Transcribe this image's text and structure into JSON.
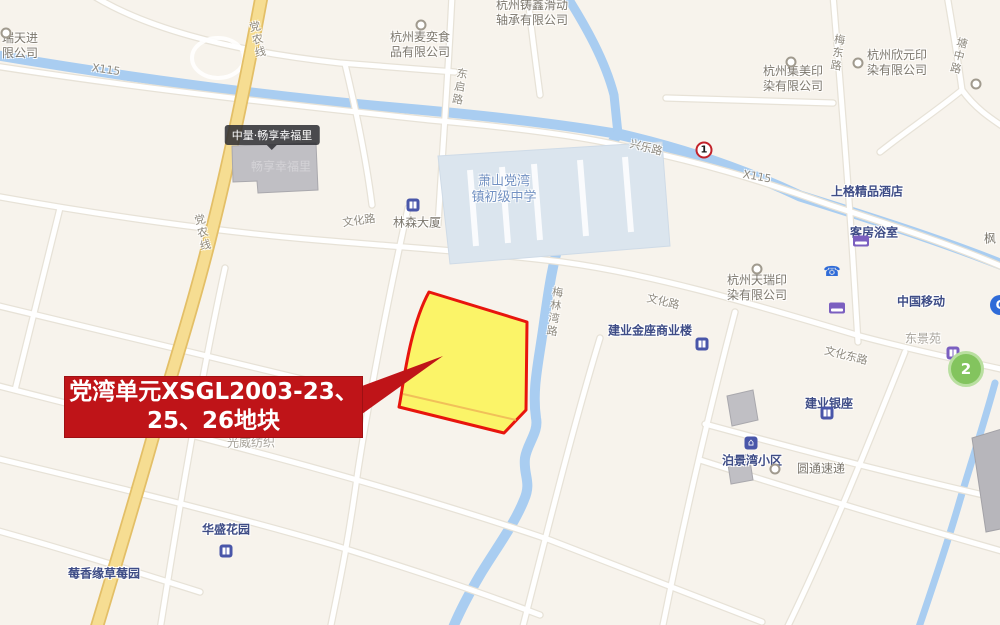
{
  "callout": {
    "line1": "党湾单元XSGL2003-23、",
    "line2": "25、26地块"
  },
  "roads": {
    "x115_nw": "X115",
    "x115_e": "X115",
    "dangnong_n": "党农线",
    "dangnong_s": "党农线",
    "dongqi": "东启路",
    "xingle": "兴乐路",
    "meidong": "梅东路",
    "tangzhong": "塘中路",
    "wenhua_w": "文化路",
    "wenhua_e": "文化路",
    "wenhuadong": "文化东路",
    "meilinwan": "梅林湾路"
  },
  "places": {
    "ruitianjin": "瑞天进\n限公司",
    "zhuxin": "杭州铸鑫滑动\n轴承有限公司",
    "maiyi": "杭州麦奕食\n品有限公司",
    "jimei": "杭州集美印\n染有限公司",
    "xinyuan": "杭州欣元印\n染有限公司",
    "jimian": "杭州集棉印\n染有限公司",
    "feng": "枫",
    "shangge": "上格精品酒店",
    "kefang": "客房浴室",
    "tianrui": "杭州天瑞印\n染有限公司",
    "school": "萧山党湾\n镇初级中学",
    "linsen": "林森大厦",
    "zhongliang": "中量·畅享幸福里",
    "changxiang": "畅享幸福里",
    "jinzuo": "建业金座商业楼",
    "yidong": "中国移动",
    "dongjingyuan": "东景苑",
    "yinzuo": "建业银座",
    "bojingwan": "泊景湾小区",
    "yuantong": "圆通速递",
    "guangwei": "光威纺织",
    "huasheng": "华盛花园",
    "meixiangyuan": "莓香缘草莓园"
  },
  "badges": {
    "metro_line": "2",
    "road_point": "1",
    "blue_circle": "C"
  },
  "colors": {
    "background": "#f7f3ec",
    "water": "#a9cdf1",
    "yellow_road": "#f6dd92",
    "parcel_fill": "#fbf45c",
    "parcel_border": "#e8150d",
    "callout_bg": "#bf1418",
    "school_area": "#dbe5ee",
    "metro_green": "#83c45e"
  }
}
